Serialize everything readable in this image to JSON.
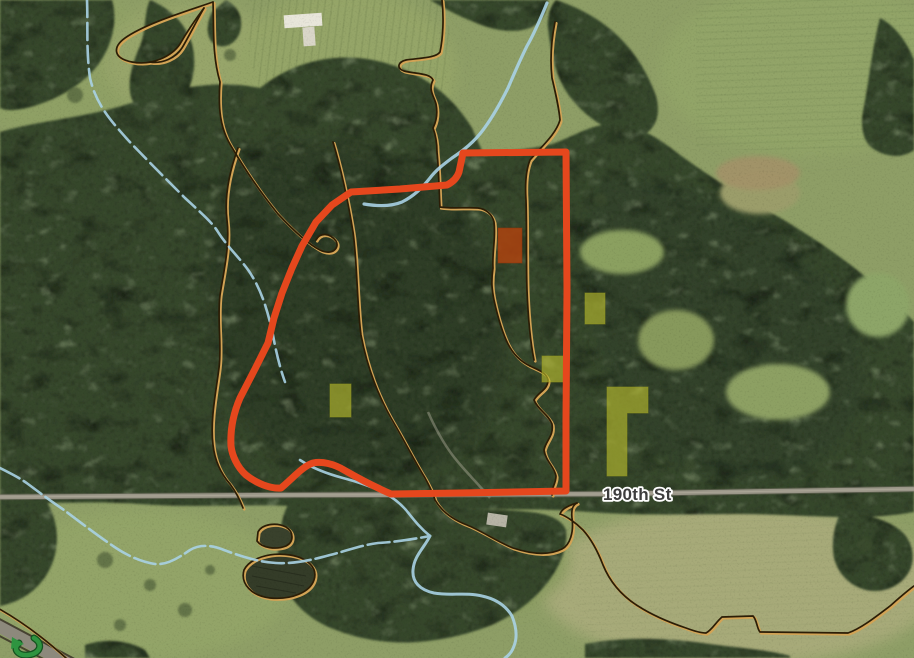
{
  "labels": {
    "road": "190th St"
  },
  "icons": {
    "flow_arrow_icon": "green-curved-arrow"
  },
  "colors": {
    "boundary": "#e5471d",
    "highlight_fill": "#bcbe2e",
    "highlight_edge": "#8f931c",
    "flagged_fill": "#b2430f",
    "flagged_edge": "#8d330b",
    "stream": "#a9d2e4",
    "soil_line": "#d2a355",
    "soil_line_edge": "#2b1d06",
    "road_fill": "#9a9688",
    "road_edge": "#6e6a5c",
    "label_text": "#3d3d3d",
    "label_halo": "#ffffff",
    "arrow": "#2e9440",
    "arrow_edge": "#14531f"
  }
}
